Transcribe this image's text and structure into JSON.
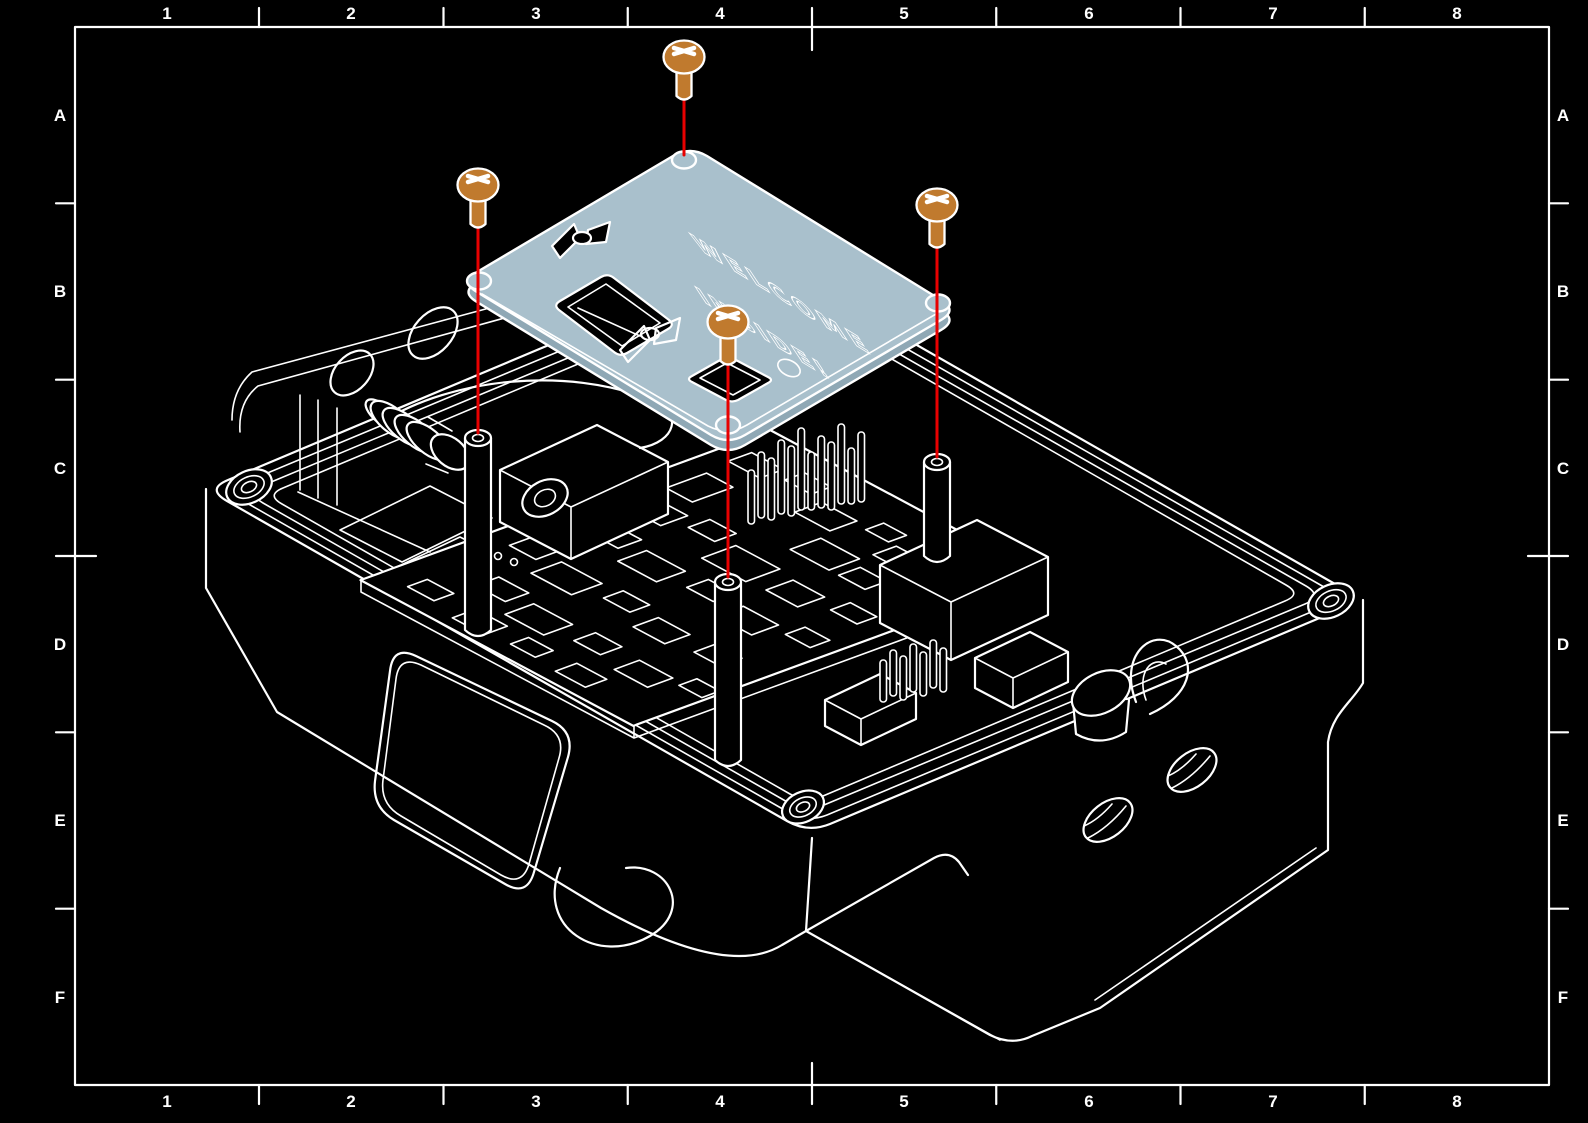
{
  "drawing": {
    "grid": {
      "columns": [
        "1",
        "2",
        "3",
        "4",
        "5",
        "6",
        "7",
        "8"
      ],
      "rows": [
        "A",
        "B",
        "C",
        "D",
        "E",
        "F"
      ]
    },
    "plate": {
      "text_line1": "WELCOME",
      "text_line2": "INSIDE!"
    },
    "colors": {
      "background": "#000000",
      "linework": "#ffffff",
      "plate_fill": "#a9c0cc",
      "plate_side": "#8fa8b5",
      "screw_fill": "#c07a2e",
      "guide_line": "#e80000"
    }
  }
}
